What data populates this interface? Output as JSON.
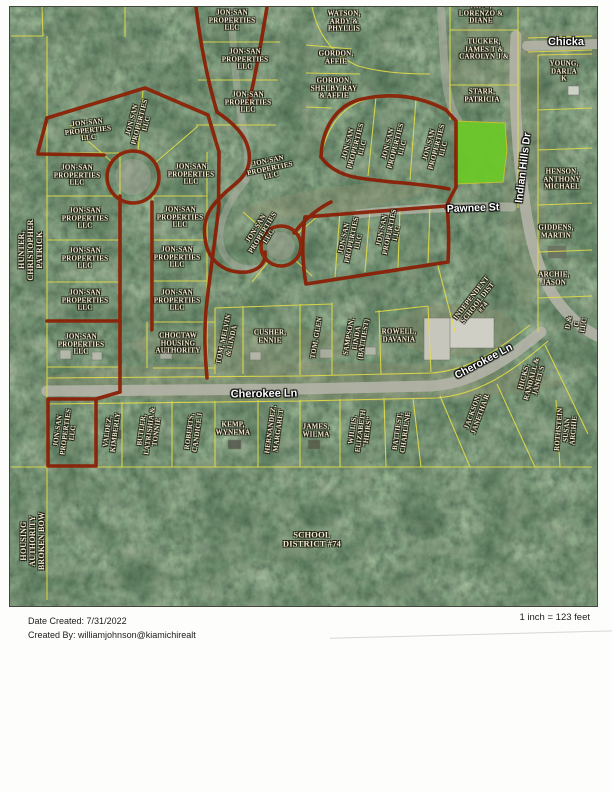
{
  "page": {
    "footer": {
      "date_label": "Date Created:",
      "date_value": "7/31/2022",
      "created_by_label": "Created By:",
      "created_by_value": "williamjohnson@kiamichirealt",
      "scale": "1 inch = 123 feet"
    }
  },
  "map": {
    "colors": {
      "parcel_line_yellow": "#e3dc46",
      "boundary_red": "#8a1d04",
      "highlight_green": "#6cc829",
      "road_gray": "#b6b5aa",
      "label_text": "#f1ead2",
      "forest_green": "#2e4c36"
    },
    "street_labels": [
      {
        "t": "Chicka",
        "x": 566,
        "y": 42,
        "r": 0,
        "s": 11
      },
      {
        "t": "Indian Hills Dr",
        "x": 524,
        "y": 168,
        "r": -83,
        "s": 10.5
      },
      {
        "t": "Pawnee St",
        "x": 473,
        "y": 209,
        "r": -2,
        "s": 10.5
      },
      {
        "t": "Cherokee Ln",
        "x": 264,
        "y": 394,
        "r": -1,
        "s": 11
      },
      {
        "t": "Cherokee Ln",
        "x": 484,
        "y": 362,
        "r": -28,
        "s": 10.5
      }
    ],
    "parcel_labels": [
      {
        "t": "JON-SAN\nPROPERTIES\nLLC",
        "x": 232,
        "y": 21,
        "r": 0
      },
      {
        "t": "JON-SAN\nPROPERTIES\nLLC",
        "x": 245,
        "y": 60,
        "r": 0
      },
      {
        "t": "JON-SAN\nPROPERTIES\nLLC",
        "x": 248,
        "y": 103,
        "r": 0
      },
      {
        "t": "WATSON,\nARDY &\nPHYLLIS",
        "x": 344,
        "y": 22,
        "r": 0
      },
      {
        "t": "KING,\nLORENZO &\nDIANE",
        "x": 481,
        "y": 14,
        "r": 0
      },
      {
        "t": "TUCKER,\nJAMES T &\nCAROLYN J &",
        "x": 484,
        "y": 50,
        "r": 0
      },
      {
        "t": "GORDON,\nAFFIE",
        "x": 336,
        "y": 58,
        "r": 0
      },
      {
        "t": "GORDON,\nSHELBY RAY\n& AFFIE",
        "x": 334,
        "y": 89,
        "r": 0
      },
      {
        "t": "YOUNG,\nDARLA K",
        "x": 564,
        "y": 72,
        "r": 0
      },
      {
        "t": "STARR,\nPATRICIA",
        "x": 482,
        "y": 96,
        "r": 0
      },
      {
        "t": "JON-SAN\nPROPERTIES\nLLC",
        "x": 356,
        "y": 146,
        "r": -75
      },
      {
        "t": "JON-SAN\nPROPERTIES\nLLC",
        "x": 396,
        "y": 146,
        "r": -75
      },
      {
        "t": "JON-SAN\nPROPERTIES\nLLC",
        "x": 437,
        "y": 147,
        "r": -75
      },
      {
        "t": "HENSON,\nANTHONY\nMICHAEL",
        "x": 562,
        "y": 180,
        "r": 0
      },
      {
        "t": "GIDDENS,\nMARTIN",
        "x": 556,
        "y": 232,
        "r": 0
      },
      {
        "t": "ARCHIE,\nJASON",
        "x": 554,
        "y": 279,
        "r": 0
      },
      {
        "t": "HUNTER,\nCHRISTOPHER\nPATRICK",
        "x": 31,
        "y": 250,
        "r": -90,
        "s": 8
      },
      {
        "t": "JON-SAN\nPROPERTIES\nLLC",
        "x": 88,
        "y": 131,
        "r": -6
      },
      {
        "t": "JON-SAN\nPROPERTIES\nLLC",
        "x": 140,
        "y": 122,
        "r": -75
      },
      {
        "t": "JON-SAN\nPROPERTIES\nLLC",
        "x": 77,
        "y": 176,
        "r": 0
      },
      {
        "t": "JON-SAN\nPROPERTIES\nLLC",
        "x": 191,
        "y": 175,
        "r": 0
      },
      {
        "t": "JON-SAN\nPROPERTIES\nLLC",
        "x": 270,
        "y": 169,
        "r": -12
      },
      {
        "t": "JON-SAN\nPROPERTIES\nLLC",
        "x": 85,
        "y": 219,
        "r": 0
      },
      {
        "t": "JON-SAN\nPROPERTIES\nLLC",
        "x": 180,
        "y": 218,
        "r": 0
      },
      {
        "t": "JON-SAN\nPROPERTIES\nLLC",
        "x": 263,
        "y": 233,
        "r": -58
      },
      {
        "t": "JON-SAN\nPROPERTIES\nLLC",
        "x": 85,
        "y": 259,
        "r": 0
      },
      {
        "t": "JON-SAN\nPROPERTIES\nLLC",
        "x": 177,
        "y": 258,
        "r": 0
      },
      {
        "t": "JON-SAN\nPROPERTIES\nLLC",
        "x": 85,
        "y": 301,
        "r": 0
      },
      {
        "t": "JON-SAN\nPROPERTIES\nLLC",
        "x": 177,
        "y": 301,
        "r": 0
      },
      {
        "t": "JON-SAN\nPROPERTIES\nLLC",
        "x": 352,
        "y": 240,
        "r": -78
      },
      {
        "t": "JON-SAN\nPROPERTIES\nLLC",
        "x": 390,
        "y": 232,
        "r": -78
      },
      {
        "t": "JON-SAN\nPROPERTIES\nLLC",
        "x": 81,
        "y": 345,
        "r": 0
      },
      {
        "t": "CHOCTAW\nHOUSING\nAUTHORITY",
        "x": 178,
        "y": 344,
        "r": 0
      },
      {
        "t": "TOM, MELVIN\n& LINDA",
        "x": 228,
        "y": 340,
        "r": -78
      },
      {
        "t": "CUSHER,\nENNIE",
        "x": 270,
        "y": 337,
        "r": 0
      },
      {
        "t": "TOM, GLEN",
        "x": 317,
        "y": 338,
        "r": -80
      },
      {
        "t": "SAMPSON,\nLINDA\n(BATTIEST)",
        "x": 357,
        "y": 338,
        "r": -80
      },
      {
        "t": "ROWELL,\nDAVANIA",
        "x": 399,
        "y": 336,
        "r": 0
      },
      {
        "t": "INDEPENDENT\nSCHOOL DIST\n#74",
        "x": 478,
        "y": 303,
        "r": -52
      },
      {
        "t": "D & C LLC",
        "x": 577,
        "y": 324,
        "r": -80
      },
      {
        "t": "HICKS,\nRANDALL &\nJANET S",
        "x": 532,
        "y": 379,
        "r": -75
      },
      {
        "t": "JACKSON,\nJANETHA R",
        "x": 477,
        "y": 413,
        "r": -70
      },
      {
        "t": "ROTHSTEIN\nSUSAN\nARCHIE",
        "x": 567,
        "y": 430,
        "r": -85
      },
      {
        "t": "JON-SAN\nPROPERTIES\nLLC",
        "x": 66,
        "y": 432,
        "r": -82
      },
      {
        "t": "VALDEZ,\nKIMBERLY",
        "x": 112,
        "y": 432,
        "r": -82
      },
      {
        "t": "BUTLER,\nLATRISHIA &\nTONNIE",
        "x": 150,
        "y": 431,
        "r": -82
      },
      {
        "t": "ROBERTS,\nCANDICE J",
        "x": 194,
        "y": 432,
        "r": -82
      },
      {
        "t": "KEMP,\nWYNEMA",
        "x": 233,
        "y": 429,
        "r": 0
      },
      {
        "t": "HERNANDEZ,\nMARGARET",
        "x": 275,
        "y": 430,
        "r": -82
      },
      {
        "t": "JAMES,\nWILMA",
        "x": 316,
        "y": 431,
        "r": 0
      },
      {
        "t": "WILLIS,\nELIZABETH\n\"HEIRS\"",
        "x": 361,
        "y": 431,
        "r": -82
      },
      {
        "t": "BATTIEST,\nCHARLENE",
        "x": 402,
        "y": 432,
        "r": -82
      },
      {
        "t": "HOUSING\nAUTHORITY\nBROKEN BOW",
        "x": 33,
        "y": 541,
        "r": -90,
        "s": 8
      },
      {
        "t": "SCHOOL\nDISTRICT #74",
        "x": 312,
        "y": 540,
        "r": 0,
        "s": 8.5
      }
    ]
  }
}
